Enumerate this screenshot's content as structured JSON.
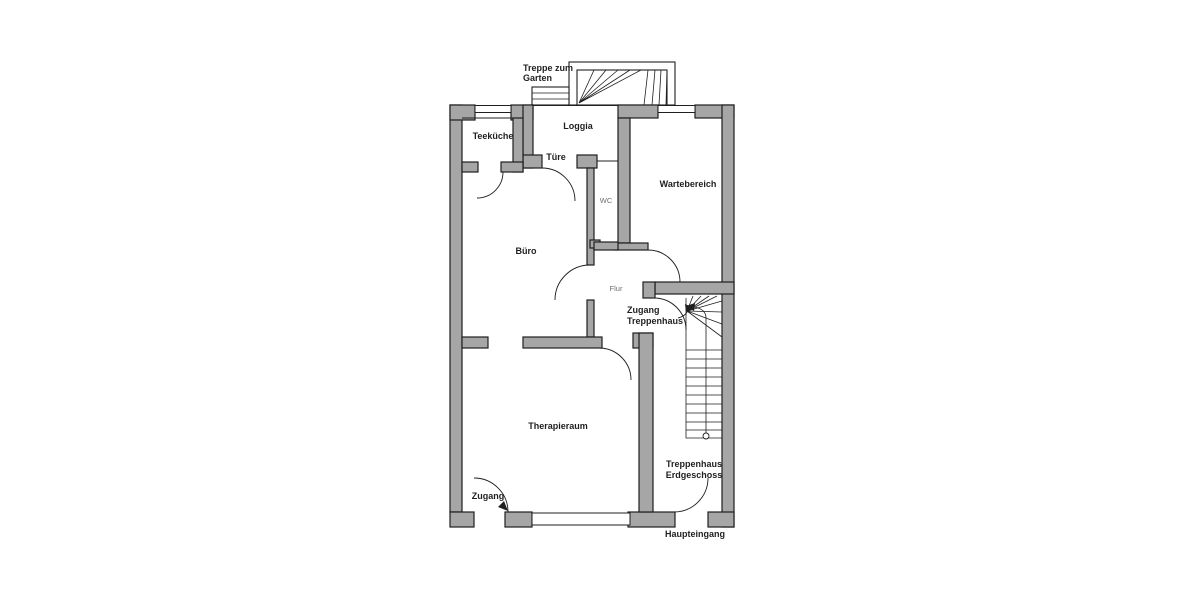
{
  "floorplan": {
    "colors": {
      "wall": "#a6a6a6",
      "line": "#1f1f1f",
      "muted": "#6e6e6e",
      "background": "#ffffff"
    },
    "labels": {
      "garden_stairs_line1": "Treppe zum",
      "garden_stairs_line2": "Garten",
      "loggia": "Loggia",
      "door": "Türe",
      "kitchenette": "Teeküche",
      "waiting_area": "Wartebereich",
      "wc": "WC",
      "office": "Büro",
      "hallway": "Flur",
      "stair_access_line1": "Zugang",
      "stair_access_line2": "Treppenhaus",
      "therapy_room": "Therapieraum",
      "staircase_line1": "Treppenhaus",
      "staircase_line2": "Erdgeschoss",
      "entrance": "Zugang",
      "main_entrance": "Haupteingang"
    }
  }
}
